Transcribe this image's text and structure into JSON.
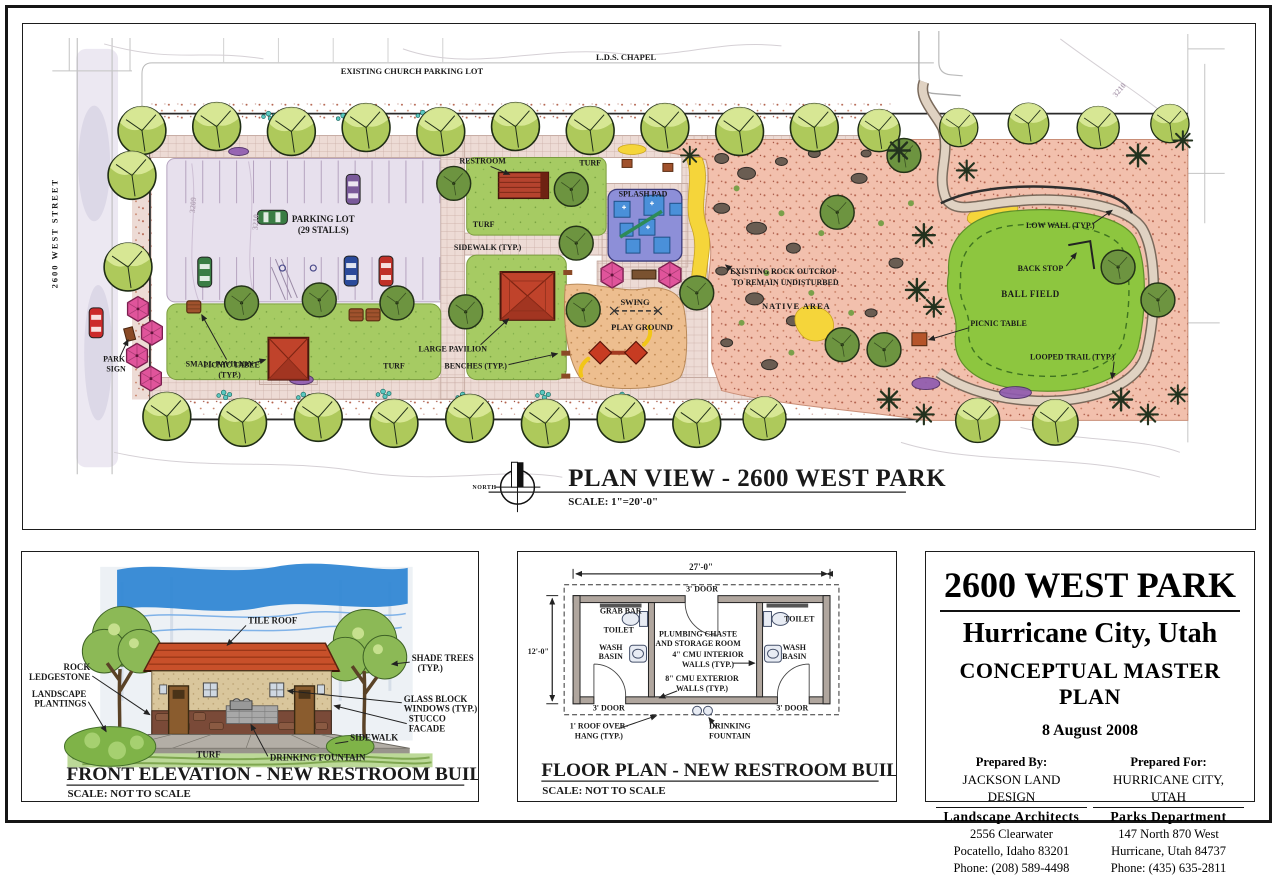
{
  "plan": {
    "street": "2600 WEST STREET",
    "church_parking": "EXISTING CHURCH PARKING LOT",
    "lds_chapel": "L.D.S. CHAPEL",
    "restroom": "RESTROOM",
    "turf": "TURF",
    "splash_pad": "SPLASH PAD",
    "sidewalk_typ": "SIDEWALK (TYP.)",
    "parking_l1": "PARKING LOT",
    "parking_l2": "(29 STALLS)",
    "park_sign_l1": "PARK",
    "park_sign_l2": "SIGN",
    "picnic_typ_l1": "PICNIC TABLE",
    "picnic_typ_l2": "(TYP.)",
    "small_pavilion": "SMALL PAVILION",
    "large_pavilion": "LARGE PAVILION",
    "benches": "BENCHES (TYP.)",
    "swing": "SWING",
    "playground": "PLAY GROUND",
    "outcrop_l1": "EXISTING ROCK OUTCROP",
    "outcrop_l2": "TO REMAIN UNDISTURBED",
    "native_area": "NATIVE AREA",
    "low_wall": "LOW WALL (TYP.)",
    "back_stop": "BACK STOP",
    "ball_field": "BALL FIELD",
    "picnic_table": "PICNIC TABLE",
    "looped_trail": "LOOPED TRAIL (TYP.)",
    "contour_3210": "3210",
    "contour_3209": "3209",
    "north": "NORTH",
    "title": "PLAN VIEW - 2600 WEST PARK",
    "scale": "SCALE: 1\"=20'-0\""
  },
  "elevation": {
    "tile_roof": "TILE ROOF",
    "rock_l1": "ROCK",
    "rock_l2": "LEDGESTONE",
    "landscape_l1": "LANDSCAPE",
    "landscape_l2": "PLANTINGS",
    "shade_l1": "SHADE TREES",
    "shade_l2": "(TYP.)",
    "glass_l1": "GLASS BLOCK",
    "glass_l2": "WINDOWS (TYP.)",
    "stucco_l1": "STUCCO",
    "stucco_l2": "FACADE",
    "sidewalk": "SIDEWALK",
    "turf": "TURF",
    "drinking_fountain": "DRINKING FOUNTAIN",
    "title": "FRONT ELEVATION - NEW RESTROOM BUILDING",
    "scale": "SCALE: NOT TO SCALE"
  },
  "floor": {
    "dim_width": "27'-0\"",
    "dim_height": "12'-0\"",
    "door3": "3' DOOR",
    "grab_bar": "GRAB BAR",
    "toilet": "TOILET",
    "plumbing_l1": "PLUMBING CHASTE",
    "plumbing_l2": "AND STORAGE ROOM",
    "wash_l1": "WASH",
    "wash_l2": "BASIN",
    "cmu4_l1": "4\" CMU INTERIOR",
    "cmu8_l1": "8\" CMU EXTERIOR",
    "walls_typ": "WALLS (TYP.)",
    "overhang_l1": "1' ROOF OVER-",
    "overhang_l2": "HANG (TYP.)",
    "fountain_l1": "DRINKING",
    "fountain_l2": "FOUNTAIN",
    "title": "FLOOR PLAN - NEW RESTROOM BUILDING",
    "scale": "SCALE: NOT TO SCALE"
  },
  "title_block": {
    "park_name": "2600 WEST PARK",
    "city": "Hurricane City, Utah",
    "doc_type": "CONCEPTUAL MASTER PLAN",
    "date": "8 August 2008",
    "prepared_by_label": "Prepared By:",
    "by_name": "JACKSON LAND DESIGN",
    "by_role": "Landscape Architects",
    "by_addr1": "2556 Clearwater",
    "by_addr2": "Pocatello, Idaho  83201",
    "by_phone": "Phone: (208) 589-4498",
    "prepared_for_label": "Prepared For:",
    "for_name": "HURRICANE CITY, UTAH",
    "for_role": "Parks Department",
    "for_addr1": "147 North  870 West",
    "for_addr2": "Hurricane, Utah  84737",
    "for_phone": "Phone: (435) 635-2811"
  },
  "colors": {
    "turf_green": "#a6cb63",
    "ball_field_green": "#8dc63f",
    "native_salmon": "#f2c0ad",
    "splash_pad_purple": "#8d8fd8",
    "splash_water_blue": "#4a90d9",
    "pavilion_roof_red": "#c0432b",
    "umbrella_pink": "#e0549b",
    "parking_lavender": "#e7e0ed",
    "walkway_tan": "#eddbd5",
    "accent_yellow": "#f5d53a"
  }
}
